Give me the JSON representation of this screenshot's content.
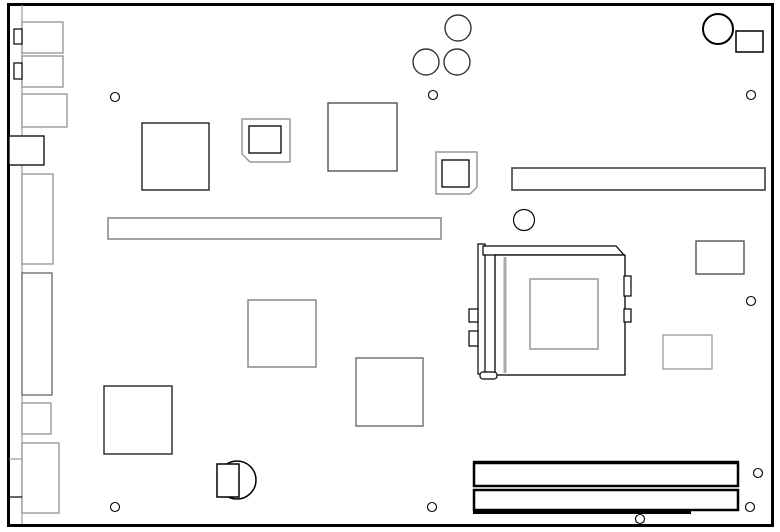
{
  "app": {
    "type": "technical-line-diagram",
    "subject": "motherboard component layout (top view)"
  },
  "canvas": {
    "width": 780,
    "height": 532,
    "background": "#ffffff",
    "default_stroke": "#000000",
    "default_fill": "#ffffff"
  },
  "shapes": [
    {
      "kind": "rect",
      "name": "board-outline",
      "x": 8.5,
      "y": 4.5,
      "w": 764,
      "h": 521,
      "stroke": "#000000",
      "sw": 3
    },
    {
      "kind": "line",
      "name": "rear-io-edge-line",
      "x1": 22,
      "y1": 5,
      "x2": 22,
      "y2": 524,
      "stroke": "#999999",
      "sw": 1.2
    },
    {
      "kind": "rect",
      "name": "io-connector-1",
      "x": 22,
      "y": 22,
      "w": 41,
      "h": 31,
      "stroke": "#999999",
      "sw": 1.4
    },
    {
      "kind": "rect",
      "name": "io-connector-1-tab",
      "x": 14,
      "y": 29,
      "w": 8,
      "h": 15,
      "stroke": "#000000",
      "sw": 1.2
    },
    {
      "kind": "rect",
      "name": "io-connector-2",
      "x": 22,
      "y": 56,
      "w": 41,
      "h": 31,
      "stroke": "#999999",
      "sw": 1.4
    },
    {
      "kind": "rect",
      "name": "io-connector-2-tab",
      "x": 14,
      "y": 63,
      "w": 8,
      "h": 16,
      "stroke": "#000000",
      "sw": 1.2
    },
    {
      "kind": "rect",
      "name": "io-connector-3",
      "x": 22,
      "y": 94,
      "w": 45,
      "h": 33,
      "stroke": "#999999",
      "sw": 1.4
    },
    {
      "kind": "rect",
      "name": "io-connector-4",
      "x": 9,
      "y": 136,
      "w": 35,
      "h": 29,
      "stroke": "#000000",
      "sw": 1.3
    },
    {
      "kind": "rect",
      "name": "io-connector-5",
      "x": 22,
      "y": 174,
      "w": 31,
      "h": 90,
      "stroke": "#999999",
      "sw": 1.4
    },
    {
      "kind": "rect",
      "name": "io-connector-6",
      "x": 22,
      "y": 273,
      "w": 30,
      "h": 122,
      "stroke": "#666666",
      "sw": 1.3
    },
    {
      "kind": "rect",
      "name": "io-connector-7",
      "x": 22,
      "y": 403,
      "w": 29,
      "h": 31,
      "stroke": "#999999",
      "sw": 1.4
    },
    {
      "kind": "rect",
      "name": "io-connector-8",
      "x": 22,
      "y": 443,
      "w": 37,
      "h": 70,
      "stroke": "#999999",
      "sw": 1.4
    },
    {
      "kind": "line",
      "name": "io-divider-line-1",
      "x1": 9,
      "y1": 459,
      "x2": 22,
      "y2": 459,
      "stroke": "#999999",
      "sw": 1.2
    },
    {
      "kind": "line",
      "name": "io-divider-line-2",
      "x1": 9,
      "y1": 497,
      "x2": 22,
      "y2": 497,
      "stroke": "#000000",
      "sw": 1.2
    },
    {
      "kind": "rect",
      "name": "chip-1",
      "x": 142,
      "y": 123,
      "w": 67,
      "h": 67,
      "stroke": "#111111",
      "sw": 1.3
    },
    {
      "kind": "polygon",
      "name": "plcc-socket-1-outer",
      "points": [
        [
          242,
          119
        ],
        [
          290,
          119
        ],
        [
          290,
          162
        ],
        [
          250,
          162
        ],
        [
          242,
          154
        ]
      ],
      "stroke": "#999999",
      "sw": 1.5
    },
    {
      "kind": "rect",
      "name": "plcc-socket-1-inner",
      "x": 249,
      "y": 126,
      "w": 32,
      "h": 27,
      "stroke": "#000000",
      "sw": 1.3
    },
    {
      "kind": "rect",
      "name": "chip-2",
      "x": 328,
      "y": 103,
      "w": 69,
      "h": 68,
      "stroke": "#444444",
      "sw": 1.3
    },
    {
      "kind": "polygon",
      "name": "plcc-socket-2-outer",
      "points": [
        [
          436,
          152
        ],
        [
          477,
          152
        ],
        [
          477,
          187
        ],
        [
          470,
          194
        ],
        [
          436,
          194
        ]
      ],
      "stroke": "#999999",
      "sw": 1.5
    },
    {
      "kind": "rect",
      "name": "plcc-socket-2-inner",
      "x": 442,
      "y": 160,
      "w": 27,
      "h": 27,
      "stroke": "#000000",
      "sw": 1.3
    },
    {
      "kind": "rect",
      "name": "slot-connector-right",
      "x": 512,
      "y": 168,
      "w": 253,
      "h": 22,
      "stroke": "#555555",
      "sw": 1.8
    },
    {
      "kind": "rect",
      "name": "slot-connector-left",
      "x": 108,
      "y": 218,
      "w": 333,
      "h": 21,
      "stroke": "#999999",
      "sw": 1.8
    },
    {
      "kind": "rect",
      "name": "chip-3",
      "x": 248,
      "y": 300,
      "w": 68,
      "h": 67,
      "stroke": "#888888",
      "sw": 1.5
    },
    {
      "kind": "rect",
      "name": "chip-4",
      "x": 356,
      "y": 358,
      "w": 67,
      "h": 68,
      "stroke": "#777777",
      "sw": 1.5
    },
    {
      "kind": "rect",
      "name": "chip-5",
      "x": 104,
      "y": 386,
      "w": 68,
      "h": 68,
      "stroke": "#333333",
      "sw": 1.5
    },
    {
      "kind": "rect",
      "name": "connector-right-1",
      "x": 696,
      "y": 241,
      "w": 48,
      "h": 33,
      "stroke": "#444444",
      "sw": 1.3
    },
    {
      "kind": "rect",
      "name": "connector-right-2",
      "x": 663,
      "y": 335,
      "w": 49,
      "h": 34,
      "stroke": "#999999",
      "sw": 1.3
    },
    {
      "kind": "rect",
      "name": "cpu-socket-lever-bar",
      "x": 478,
      "y": 244,
      "w": 7,
      "h": 130,
      "stroke": "#000000",
      "sw": 1.2
    },
    {
      "kind": "polygon",
      "name": "cpu-socket-top-bar",
      "points": [
        [
          483,
          246
        ],
        [
          616,
          246
        ],
        [
          624,
          255
        ],
        [
          483,
          255
        ]
      ],
      "stroke": "#000000",
      "sw": 1.2
    },
    {
      "kind": "rect",
      "name": "cpu-socket-body",
      "x": 495,
      "y": 255,
      "w": 130,
      "h": 120,
      "stroke": "#000000",
      "sw": 1.3
    },
    {
      "kind": "line",
      "name": "cpu-socket-guide-line",
      "x1": 505,
      "y1": 257,
      "x2": 505,
      "y2": 373,
      "stroke": "#aaaaaa",
      "sw": 3
    },
    {
      "kind": "rect",
      "name": "cpu-die",
      "x": 530,
      "y": 279,
      "w": 68,
      "h": 70,
      "stroke": "#999999",
      "sw": 1.5
    },
    {
      "kind": "rect",
      "name": "cpu-tab-left-1",
      "x": 469,
      "y": 309,
      "w": 9,
      "h": 13,
      "stroke": "#000000",
      "sw": 1.2
    },
    {
      "kind": "rect",
      "name": "cpu-tab-left-2",
      "x": 469,
      "y": 331,
      "w": 9,
      "h": 15,
      "stroke": "#000000",
      "sw": 1.2
    },
    {
      "kind": "rect",
      "name": "cpu-tab-right-1",
      "x": 624,
      "y": 276,
      "w": 7,
      "h": 20,
      "stroke": "#000000",
      "sw": 1.2
    },
    {
      "kind": "rect",
      "name": "cpu-tab-right-2",
      "x": 624,
      "y": 309,
      "w": 7,
      "h": 13,
      "stroke": "#000000",
      "sw": 1.2
    },
    {
      "kind": "rect",
      "name": "cpu-lever-foot",
      "x": 480,
      "y": 372,
      "w": 17,
      "h": 7,
      "rx": 3,
      "stroke": "#000000",
      "sw": 1.2
    },
    {
      "kind": "circle",
      "name": "cmos-battery-cell",
      "cx": 237,
      "cy": 480,
      "r": 19,
      "stroke": "#000000",
      "sw": 1.5
    },
    {
      "kind": "rect",
      "name": "cmos-battery-holder",
      "x": 217,
      "y": 464,
      "w": 22,
      "h": 33,
      "stroke": "#000000",
      "sw": 1.5
    },
    {
      "kind": "rect",
      "name": "dimm-slot-1",
      "x": 474,
      "y": 463,
      "w": 264,
      "h": 23,
      "stroke": "#000000",
      "sw": 2.5
    },
    {
      "kind": "line",
      "name": "dimm-slot-1-top-edge",
      "x1": 473,
      "y1": 462,
      "x2": 739,
      "y2": 462,
      "stroke": "#000000",
      "sw": 2.5
    },
    {
      "kind": "rect",
      "name": "dimm-slot-2",
      "x": 474,
      "y": 490,
      "w": 264,
      "h": 20,
      "stroke": "#000000",
      "sw": 2.5
    },
    {
      "kind": "rect",
      "name": "dimm-slot-2-key",
      "x": 473,
      "y": 510,
      "w": 218,
      "h": 4,
      "fill": "#000000",
      "stroke": "none",
      "sw": 0
    },
    {
      "kind": "circle",
      "name": "corner-circle",
      "cx": 718,
      "cy": 29,
      "r": 15,
      "stroke": "#000000",
      "sw": 2
    },
    {
      "kind": "rect",
      "name": "corner-connector",
      "x": 736,
      "y": 31,
      "w": 27,
      "h": 21,
      "stroke": "#000000",
      "sw": 1.5
    },
    {
      "kind": "circle",
      "name": "capacitor-1",
      "cx": 458,
      "cy": 28,
      "r": 13,
      "stroke": "#333333",
      "sw": 1.4
    },
    {
      "kind": "circle",
      "name": "capacitor-2",
      "cx": 426,
      "cy": 62,
      "r": 13,
      "stroke": "#333333",
      "sw": 1.4
    },
    {
      "kind": "circle",
      "name": "capacitor-3",
      "cx": 457,
      "cy": 62,
      "r": 13,
      "stroke": "#333333",
      "sw": 1.4
    },
    {
      "kind": "circle",
      "name": "hole-large",
      "cx": 524,
      "cy": 220,
      "r": 10.5,
      "stroke": "#000000",
      "sw": 1.2
    },
    {
      "kind": "circle",
      "name": "mounting-hole-1",
      "cx": 115,
      "cy": 97,
      "r": 4.5,
      "stroke": "#000000",
      "sw": 1.1
    },
    {
      "kind": "circle",
      "name": "mounting-hole-2",
      "cx": 433,
      "cy": 95,
      "r": 4.5,
      "stroke": "#000000",
      "sw": 1.1
    },
    {
      "kind": "circle",
      "name": "mounting-hole-3",
      "cx": 751,
      "cy": 95,
      "r": 4.5,
      "stroke": "#000000",
      "sw": 1.1
    },
    {
      "kind": "circle",
      "name": "mounting-hole-4",
      "cx": 751,
      "cy": 301,
      "r": 4.5,
      "stroke": "#000000",
      "sw": 1.1
    },
    {
      "kind": "circle",
      "name": "mounting-hole-5",
      "cx": 758,
      "cy": 473,
      "r": 4.5,
      "stroke": "#000000",
      "sw": 1.1
    },
    {
      "kind": "circle",
      "name": "mounting-hole-6",
      "cx": 750,
      "cy": 507,
      "r": 4.5,
      "stroke": "#000000",
      "sw": 1.1
    },
    {
      "kind": "circle",
      "name": "mounting-hole-7",
      "cx": 640,
      "cy": 519,
      "r": 4.5,
      "stroke": "#000000",
      "sw": 1.1
    },
    {
      "kind": "circle",
      "name": "mounting-hole-8",
      "cx": 432,
      "cy": 507,
      "r": 4.5,
      "stroke": "#000000",
      "sw": 1.1
    },
    {
      "kind": "circle",
      "name": "mounting-hole-9",
      "cx": 115,
      "cy": 507,
      "r": 4.5,
      "stroke": "#000000",
      "sw": 1.1
    }
  ]
}
